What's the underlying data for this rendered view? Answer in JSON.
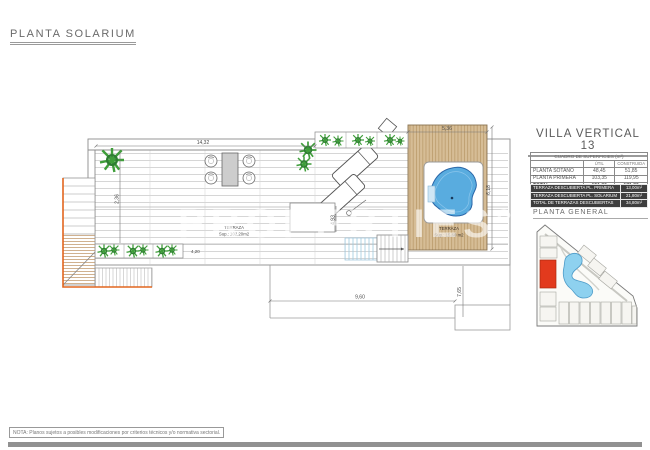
{
  "sheet": {
    "title": "PLANTA SOLARIUM",
    "note": "NOTA: Planos sujetos a posibles modificaciones por criterios técnicos y/o normativa sectorial.",
    "watermark": "PROPERTIES°"
  },
  "right_panel": {
    "heading": "VILLA VERTICAL 13",
    "surfaces_table": {
      "title": "CUADRO DE SUPERFICIES (m²)",
      "col_headers": [
        "ÚTIL",
        "CONSTRUIDA"
      ],
      "rows": [
        {
          "label": "PLANTA SOTANO",
          "util": "48,45",
          "construida": "51,85"
        },
        {
          "label": "PLANTA PRIMERA",
          "util": "103,35",
          "construida": "119,95"
        },
        {
          "label": "TOTAL",
          "util": "151,80",
          "construida": "171,80"
        }
      ]
    },
    "terraces_table": {
      "rows": [
        {
          "label": "TERRAZA DESCUBIERTA PL. PRIMERA",
          "value": "13,00m²"
        },
        {
          "label": "TERRAZA DESCUBIERTA PL. SOLARIUM",
          "value": "21,80m²"
        },
        {
          "label": "TOTAL DE TERRAZAS DESCUBIERTAS",
          "value": "34,80m²"
        }
      ]
    },
    "site_plan_label": "PLANTA GENERAL"
  },
  "plan": {
    "labels": {
      "terraza_main": {
        "line1": "TERRAZA",
        "line2": "Sup.: 102,20m2"
      },
      "terraza_deck": {
        "line1": "TERRAZA",
        "line2": "Sup.: 15,60 m2"
      }
    },
    "dimensions": {
      "top": "14,32",
      "deck_top": "5,36",
      "deck_right": "6,18",
      "left_vert": "2,36",
      "mid_vert": "4,93",
      "planter": "4,20",
      "bottom": "9,60",
      "bottom_right_vert": "7,65"
    }
  },
  "colors": {
    "accent_orange": "#e2661f",
    "wood": "#d6bd96",
    "jacuzzi_blue": "#59acdf",
    "site_red": "#e23a1d",
    "lagoon_blue": "#8ed1ef",
    "plant_green": "#3f9e3a",
    "table_dark": "#3e3e3e"
  }
}
